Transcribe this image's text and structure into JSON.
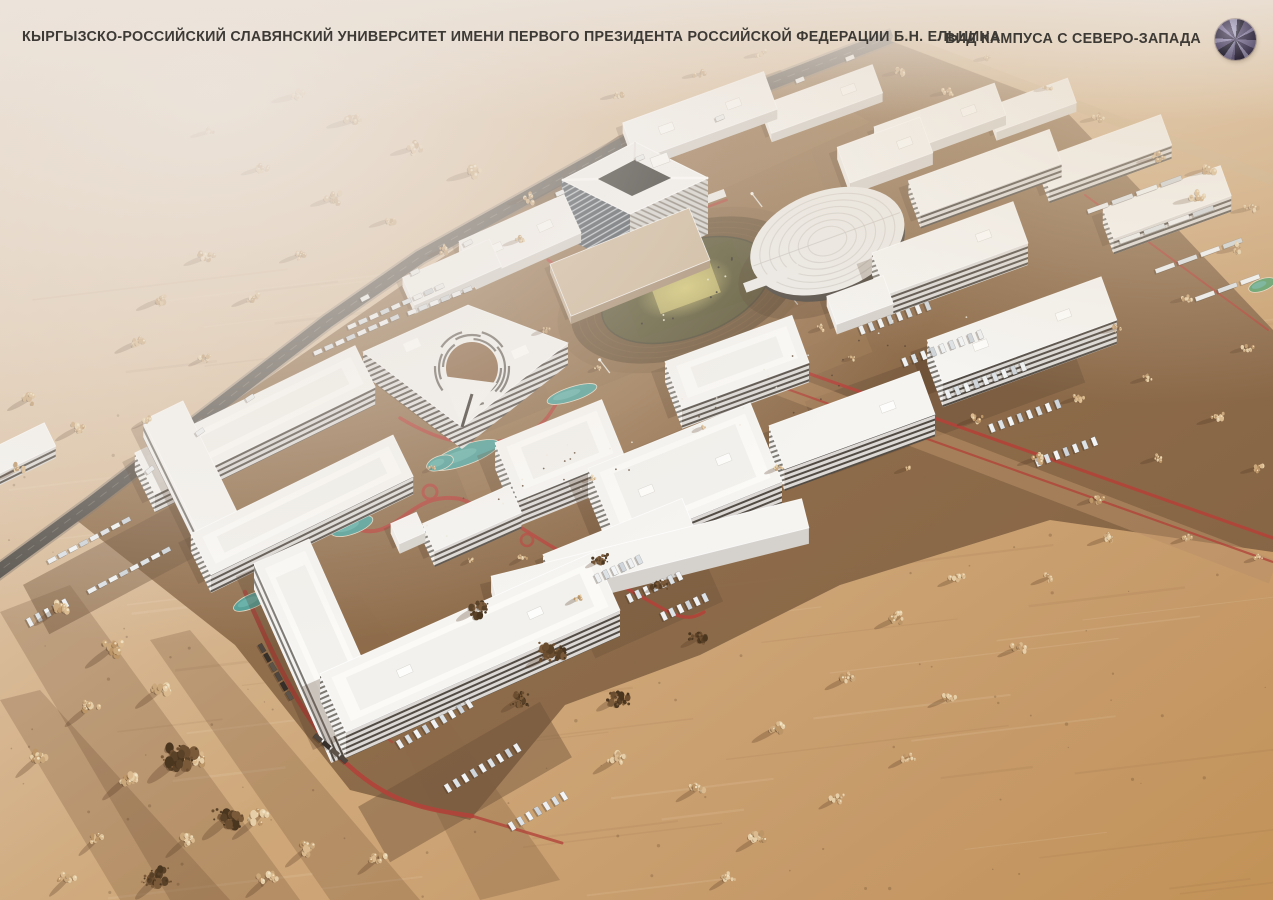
{
  "header": {
    "title": "КЫРГЫЗСКО-РОССИЙСКИЙ СЛАВЯНСКИЙ УНИВЕРСИТЕТ ИМЕНИ ПЕРВОГО ПРЕЗИДЕНТА РОССИЙСКОЙ ФЕДЕРАЦИИ Б.Н. ЕЛЬЦИНА",
    "view_label": "ВИД КАМПУСА С СЕВЕРО-ЗАПАДА"
  },
  "scene": {
    "description": "Aerial architectural rendering of the university campus seen from the north-west: white slab buildings, central tower, stadium with running track, arena, red pedestrian paths, parking lots and desert terrain with trees."
  },
  "palette": {
    "title_text": "#3d3a36",
    "haze": "#ece4dc",
    "sand_light": "#e8d9c8",
    "sand": "#cfa87a",
    "sand_dark": "#c29257",
    "ground_brown": "#9a7752",
    "ground_dark": "#7f5f41",
    "road_asphalt": "#57534d",
    "building_white": "#f5f4f1",
    "facade_dark": "#57524b",
    "glass_dark": "#3a434d",
    "path_red": "#b24339",
    "pond_teal": "#4f9e96",
    "track_brown": "#6d5336",
    "field_olive": "#5a5434",
    "field_yellow": "#d4c874",
    "tree_beige": "#dec29b",
    "tree_dark": "#59412a",
    "car_white": "#eef0f1",
    "compass_colors": [
      "#2e2937",
      "#6b5f82",
      "#a79dc0",
      "#463d56",
      "#8d82a6",
      "#544a66",
      "#b3abc9",
      "#3a3346",
      "#796f92",
      "#9b92b4"
    ]
  }
}
